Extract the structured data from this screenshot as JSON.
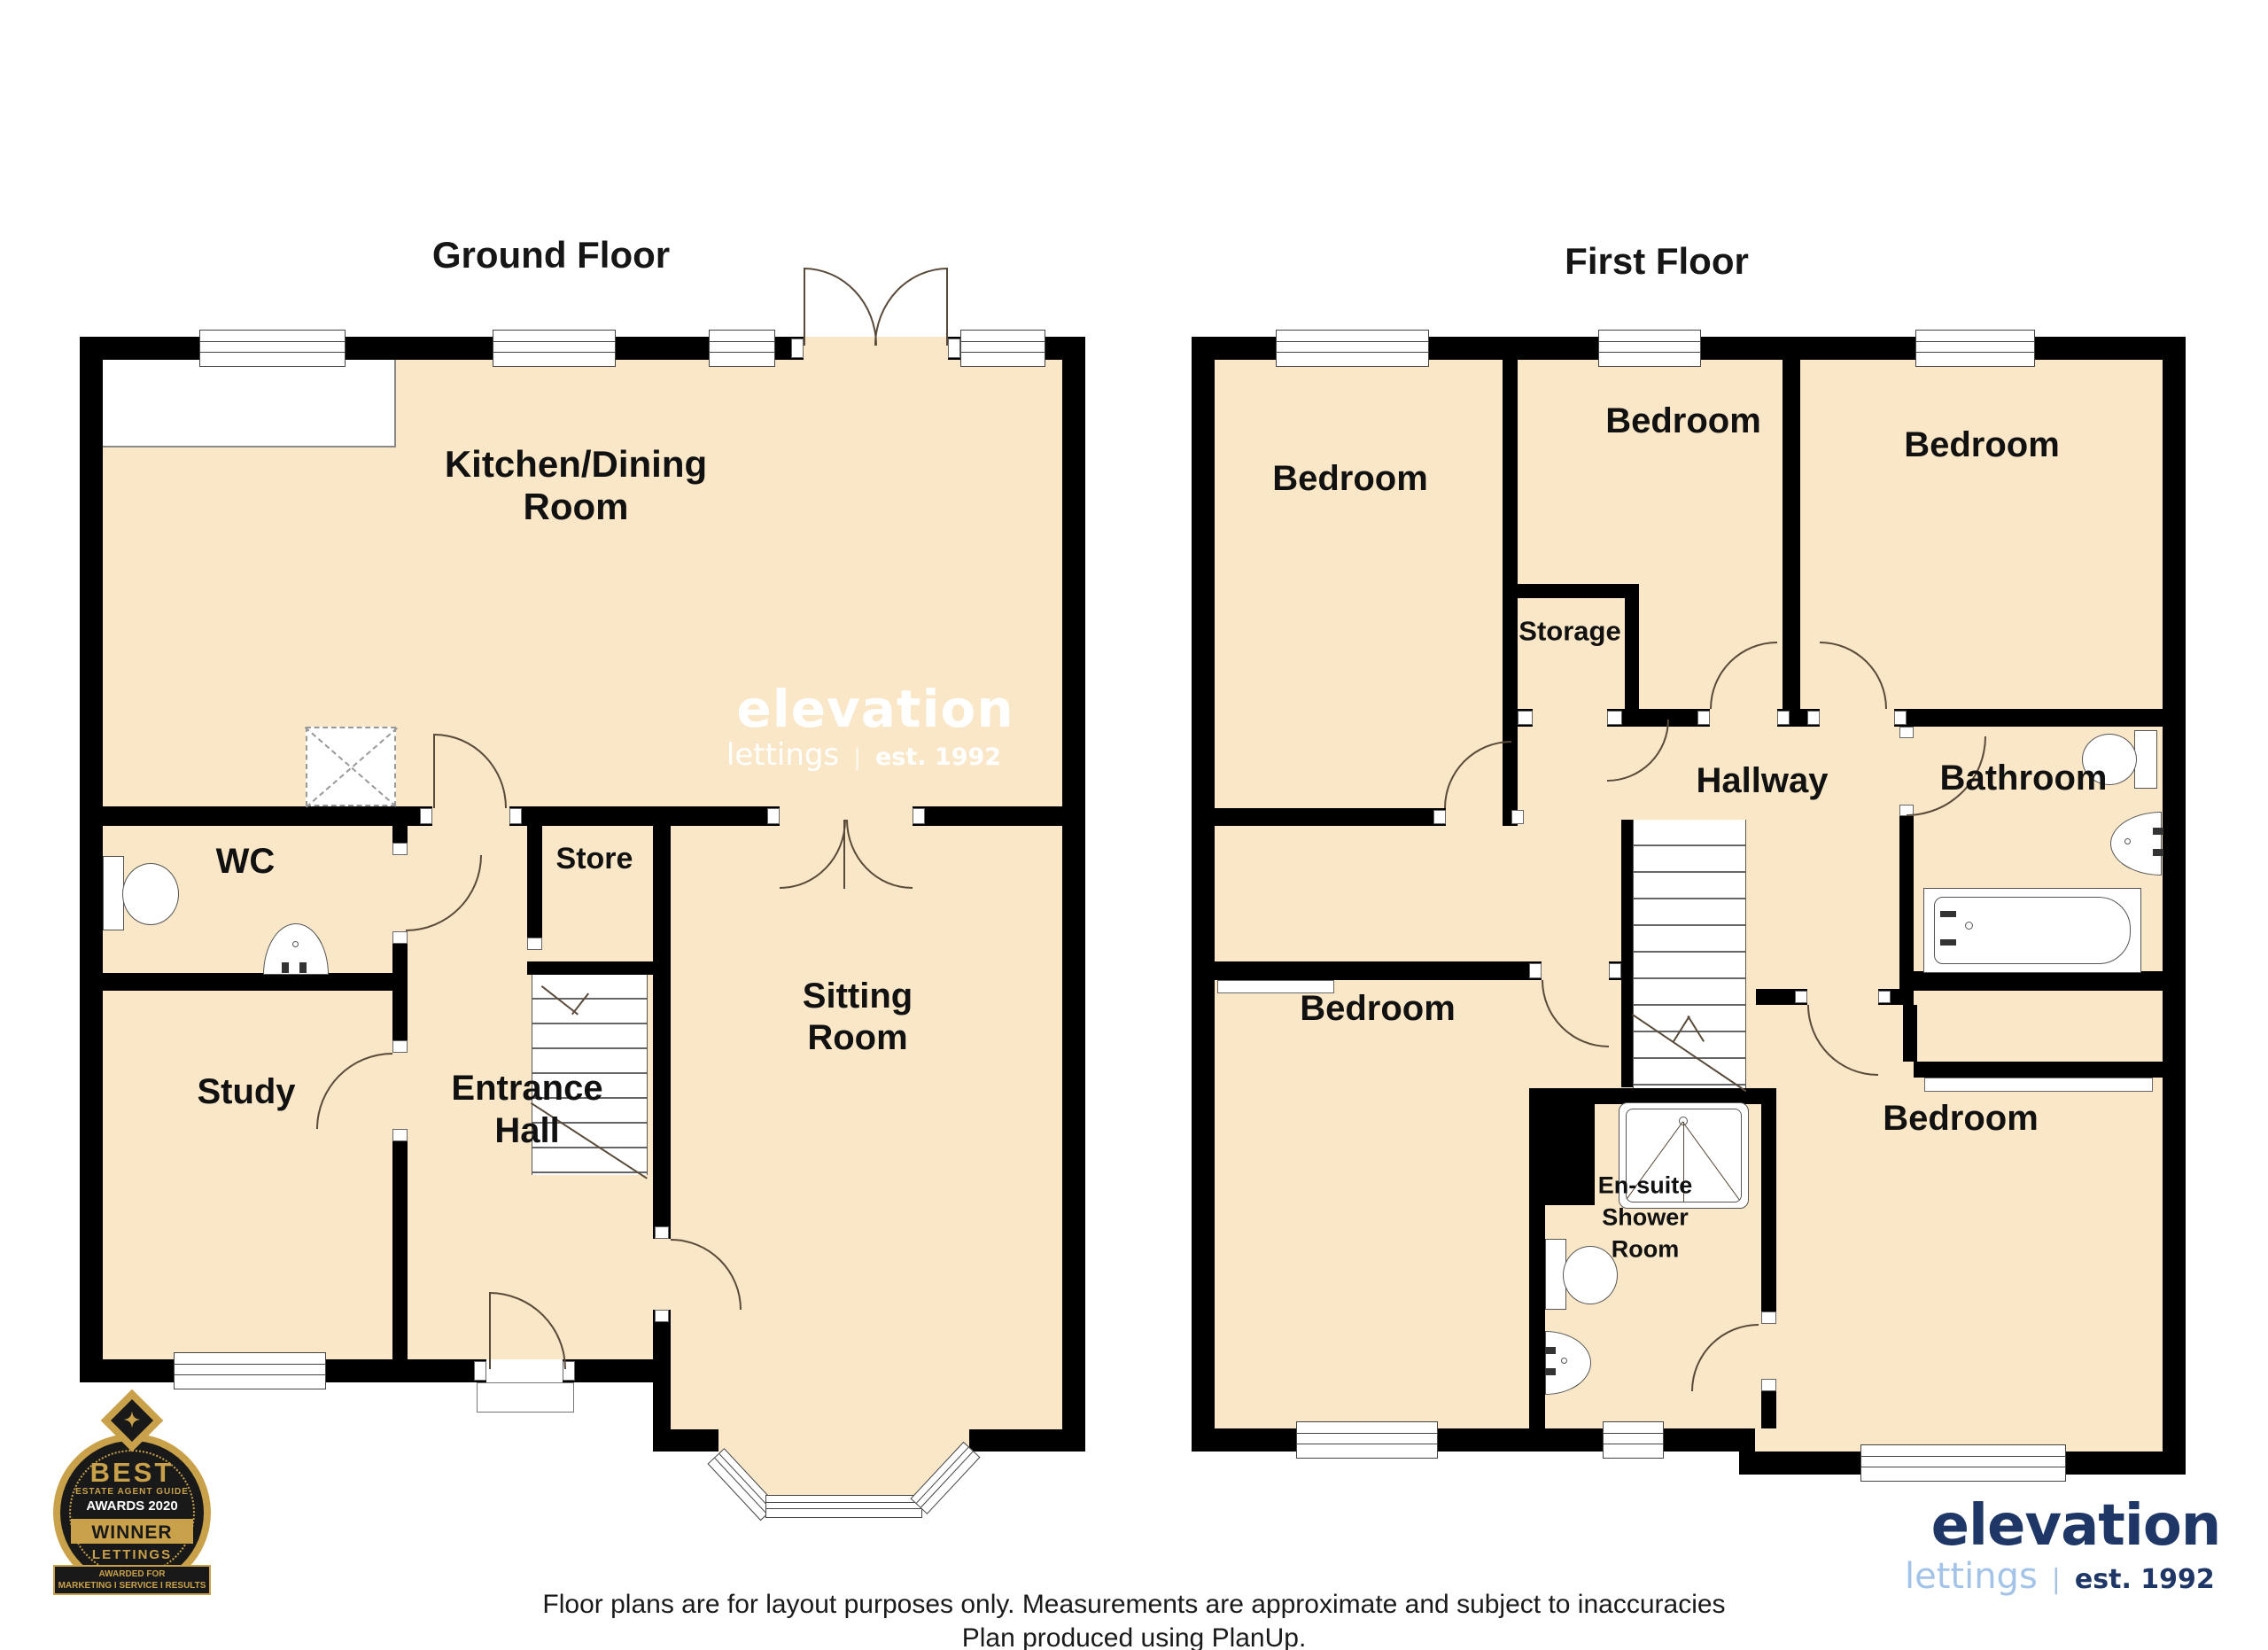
{
  "titles": {
    "ground": "Ground Floor",
    "first": "First Floor"
  },
  "ground": {
    "kitchen1": "Kitchen/Dining",
    "kitchen2": "Room",
    "wc": "WC",
    "store": "Store",
    "study": "Study",
    "entrance1": "Entrance",
    "entrance2": "Hall",
    "sitting1": "Sitting",
    "sitting2": "Room"
  },
  "first": {
    "bedroom": "Bedroom",
    "storage": "Storage",
    "hallway": "Hallway",
    "bathroom": "Bathroom",
    "ensuite1": "En-suite",
    "ensuite2": "Shower",
    "ensuite3": "Room"
  },
  "watermark": {
    "brand": "elevation",
    "sub": "lettings",
    "sep": "|",
    "est": "est. 1992"
  },
  "logo": {
    "brand": "elevation",
    "sub": "lettings",
    "sep": "|",
    "est": "est. 1992"
  },
  "badge": {
    "best": "BEST",
    "guide": "ESTATE AGENT GUIDE",
    "awards": "AWARDS 2020",
    "winner": "WINNER",
    "lettings": "LETTINGS",
    "awarded": "AWARDED FOR",
    "tagline": "MARKETING I SERVICE I RESULTS"
  },
  "footer": {
    "line1": "Floor plans are for layout purposes only. Measurements are approximate and subject to inaccuracies",
    "line2": "Plan produced using PlanUp."
  },
  "colors": {
    "floor": "#F9E7C7",
    "wall": "#000000",
    "gold": "#C9A14B",
    "badgeDark": "#191919",
    "navy": "#1F3766",
    "lightBlue": "#A3C3E8"
  }
}
